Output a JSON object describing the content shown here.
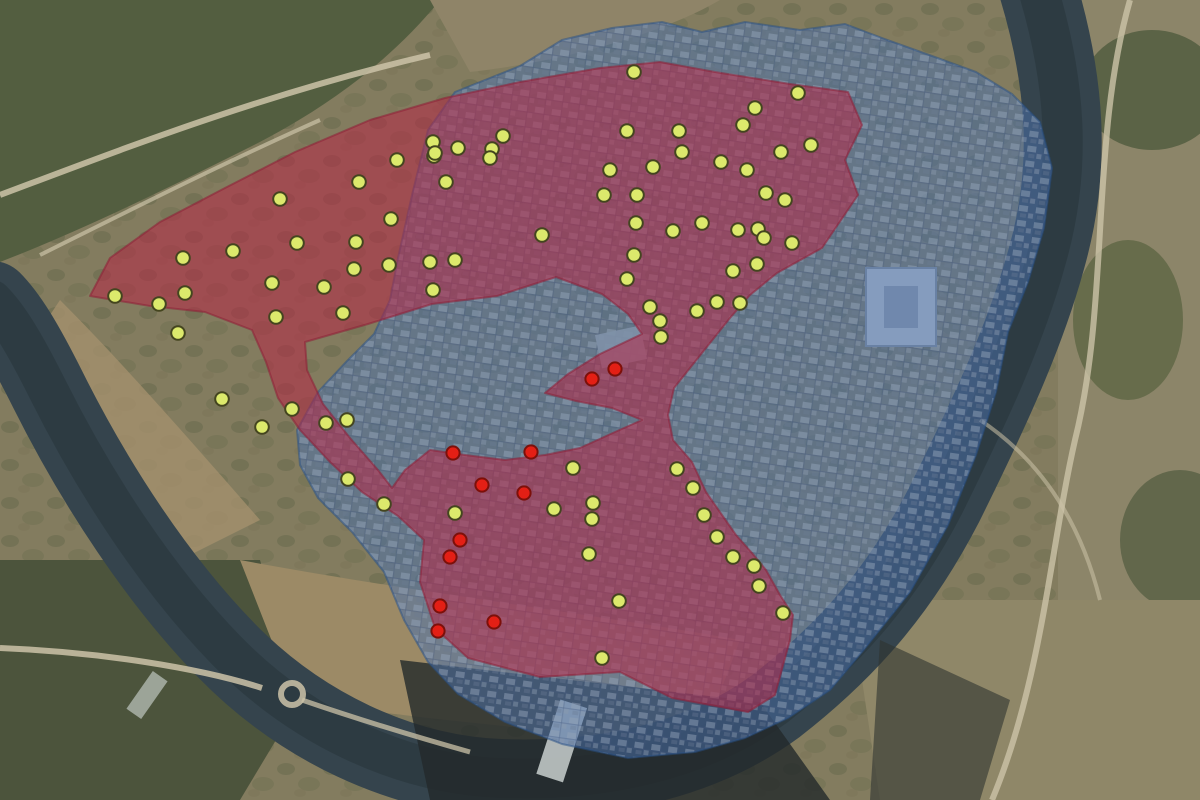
{
  "map": {
    "kind": "satellite-overlay-map",
    "width": 1200,
    "height": 800,
    "base_colors": {
      "land": "#837c5f",
      "forest": "#535e40",
      "cliffs": "#9c8a66",
      "river": "#35444d",
      "shadow": "#23292a",
      "road": "#ccc3a8",
      "rapids": "#dfe5e4"
    },
    "zones": [
      {
        "name": "zone-blue-city",
        "fill": "#4a72ad",
        "fill_opacity": 0.52,
        "stroke": "#274f86",
        "stroke_opacity": 0.5,
        "stroke_width": 2,
        "outer": [
          [
            398,
            258
          ],
          [
            412,
            195
          ],
          [
            428,
            130
          ],
          [
            455,
            92
          ],
          [
            520,
            66
          ],
          [
            562,
            40
          ],
          [
            612,
            28
          ],
          [
            662,
            22
          ],
          [
            702,
            32
          ],
          [
            745,
            22
          ],
          [
            800,
            30
          ],
          [
            845,
            24
          ],
          [
            882,
            38
          ],
          [
            932,
            56
          ],
          [
            976,
            72
          ],
          [
            1012,
            94
          ],
          [
            1040,
            122
          ],
          [
            1052,
            168
          ],
          [
            1044,
            228
          ],
          [
            1028,
            282
          ],
          [
            1008,
            332
          ],
          [
            996,
            392
          ],
          [
            976,
            455
          ],
          [
            948,
            525
          ],
          [
            910,
            592
          ],
          [
            862,
            652
          ],
          [
            830,
            690
          ],
          [
            788,
            718
          ],
          [
            745,
            738
          ],
          [
            695,
            752
          ],
          [
            628,
            758
          ],
          [
            562,
            744
          ],
          [
            505,
            722
          ],
          [
            458,
            694
          ],
          [
            428,
            662
          ],
          [
            404,
            620
          ],
          [
            384,
            572
          ],
          [
            352,
            532
          ],
          [
            318,
            498
          ],
          [
            300,
            465
          ],
          [
            297,
            430
          ],
          [
            318,
            392
          ],
          [
            346,
            362
          ],
          [
            374,
            334
          ],
          [
            390,
            300
          ]
        ],
        "holes": []
      },
      {
        "name": "zone-red-survey",
        "fill": "#b72746",
        "fill_opacity": 0.55,
        "stroke": "#8e1f36",
        "stroke_opacity": 0.55,
        "stroke_width": 2,
        "outer": [
          [
            90,
            296
          ],
          [
            110,
            258
          ],
          [
            160,
            222
          ],
          [
            225,
            188
          ],
          [
            295,
            152
          ],
          [
            370,
            120
          ],
          [
            445,
            98
          ],
          [
            520,
            82
          ],
          [
            600,
            68
          ],
          [
            660,
            62
          ],
          [
            715,
            72
          ],
          [
            790,
            84
          ],
          [
            848,
            92
          ],
          [
            862,
            125
          ],
          [
            845,
            160
          ],
          [
            858,
            195
          ],
          [
            822,
            248
          ],
          [
            777,
            273
          ],
          [
            750,
            295
          ],
          [
            730,
            318
          ],
          [
            706,
            348
          ],
          [
            674,
            388
          ],
          [
            668,
            415
          ],
          [
            673,
            440
          ],
          [
            692,
            462
          ],
          [
            706,
            492
          ],
          [
            722,
            515
          ],
          [
            736,
            535
          ],
          [
            752,
            553
          ],
          [
            766,
            570
          ],
          [
            780,
            595
          ],
          [
            793,
            615
          ],
          [
            790,
            640
          ],
          [
            775,
            695
          ],
          [
            748,
            712
          ],
          [
            672,
            698
          ],
          [
            620,
            672
          ],
          [
            540,
            677
          ],
          [
            468,
            658
          ],
          [
            435,
            628
          ],
          [
            420,
            582
          ],
          [
            424,
            540
          ],
          [
            398,
            516
          ],
          [
            362,
            492
          ],
          [
            330,
            462
          ],
          [
            300,
            430
          ],
          [
            278,
            398
          ],
          [
            266,
            362
          ],
          [
            252,
            330
          ],
          [
            205,
            312
          ],
          [
            150,
            306
          ]
        ],
        "holes": [
          [
            [
              305,
              342
            ],
            [
              368,
              324
            ],
            [
              432,
              304
            ],
            [
              497,
              296
            ],
            [
              556,
              277
            ],
            [
              602,
              294
            ],
            [
              628,
              314
            ],
            [
              642,
              334
            ],
            [
              600,
              354
            ],
            [
              568,
              374
            ],
            [
              545,
              393
            ],
            [
              576,
              401
            ],
            [
              612,
              408
            ],
            [
              642,
              420
            ],
            [
              615,
              432
            ],
            [
              580,
              448
            ],
            [
              545,
              455
            ],
            [
              505,
              460
            ],
            [
              465,
              455
            ],
            [
              430,
              450
            ],
            [
              405,
              470
            ],
            [
              392,
              488
            ],
            [
              378,
              470
            ],
            [
              350,
              438
            ],
            [
              323,
              404
            ],
            [
              307,
              370
            ]
          ]
        ]
      }
    ],
    "dot_groups": [
      {
        "name": "marker-dot-yellow",
        "fill": "#dce96c",
        "stroke": "#44451f",
        "stroke_width": 2,
        "radius": 6.8,
        "points": [
          [
            634,
            72
          ],
          [
            798,
            93
          ],
          [
            811,
            145
          ],
          [
            755,
            108
          ],
          [
            743,
            125
          ],
          [
            627,
            131
          ],
          [
            679,
            131
          ],
          [
            682,
            152
          ],
          [
            721,
            162
          ],
          [
            653,
            167
          ],
          [
            610,
            170
          ],
          [
            747,
            170
          ],
          [
            781,
            152
          ],
          [
            604,
            195
          ],
          [
            637,
            195
          ],
          [
            766,
            193
          ],
          [
            785,
            200
          ],
          [
            636,
            223
          ],
          [
            702,
            223
          ],
          [
            673,
            231
          ],
          [
            738,
            230
          ],
          [
            758,
            229
          ],
          [
            764,
            238
          ],
          [
            792,
            243
          ],
          [
            634,
            255
          ],
          [
            627,
            279
          ],
          [
            757,
            264
          ],
          [
            733,
            271
          ],
          [
            650,
            307
          ],
          [
            697,
            311
          ],
          [
            717,
            302
          ],
          [
            740,
            303
          ],
          [
            660,
            321
          ],
          [
            661,
            337
          ],
          [
            503,
            136
          ],
          [
            433,
            142
          ],
          [
            458,
            148
          ],
          [
            492,
            149
          ],
          [
            434,
            156
          ],
          [
            490,
            158
          ],
          [
            542,
            235
          ],
          [
            433,
            290
          ],
          [
            280,
            199
          ],
          [
            397,
            160
          ],
          [
            435,
            153
          ],
          [
            359,
            182
          ],
          [
            446,
            182
          ],
          [
            391,
            219
          ],
          [
            297,
            243
          ],
          [
            233,
            251
          ],
          [
            356,
            242
          ],
          [
            183,
            258
          ],
          [
            389,
            265
          ],
          [
            430,
            262
          ],
          [
            455,
            260
          ],
          [
            354,
            269
          ],
          [
            272,
            283
          ],
          [
            185,
            293
          ],
          [
            324,
            287
          ],
          [
            343,
            313
          ],
          [
            276,
            317
          ],
          [
            115,
            296
          ],
          [
            159,
            304
          ],
          [
            178,
            333
          ],
          [
            222,
            399
          ],
          [
            292,
            409
          ],
          [
            262,
            427
          ],
          [
            326,
            423
          ],
          [
            347,
            420
          ],
          [
            348,
            479
          ],
          [
            384,
            504
          ],
          [
            455,
            513
          ],
          [
            573,
            468
          ],
          [
            677,
            469
          ],
          [
            693,
            488
          ],
          [
            554,
            509
          ],
          [
            593,
            503
          ],
          [
            592,
            519
          ],
          [
            704,
            515
          ],
          [
            589,
            554
          ],
          [
            619,
            601
          ],
          [
            602,
            658
          ],
          [
            717,
            537
          ],
          [
            733,
            557
          ],
          [
            754,
            566
          ],
          [
            759,
            586
          ],
          [
            783,
            613
          ]
        ]
      },
      {
        "name": "marker-dot-red",
        "fill": "#e31f15",
        "stroke": "#7c100a",
        "stroke_width": 2,
        "radius": 6.6,
        "points": [
          [
            615,
            369
          ],
          [
            592,
            379
          ],
          [
            453,
            453
          ],
          [
            531,
            452
          ],
          [
            482,
            485
          ],
          [
            524,
            493
          ],
          [
            460,
            540
          ],
          [
            450,
            557
          ],
          [
            440,
            606
          ],
          [
            494,
            622
          ],
          [
            438,
            631
          ]
        ]
      }
    ]
  }
}
